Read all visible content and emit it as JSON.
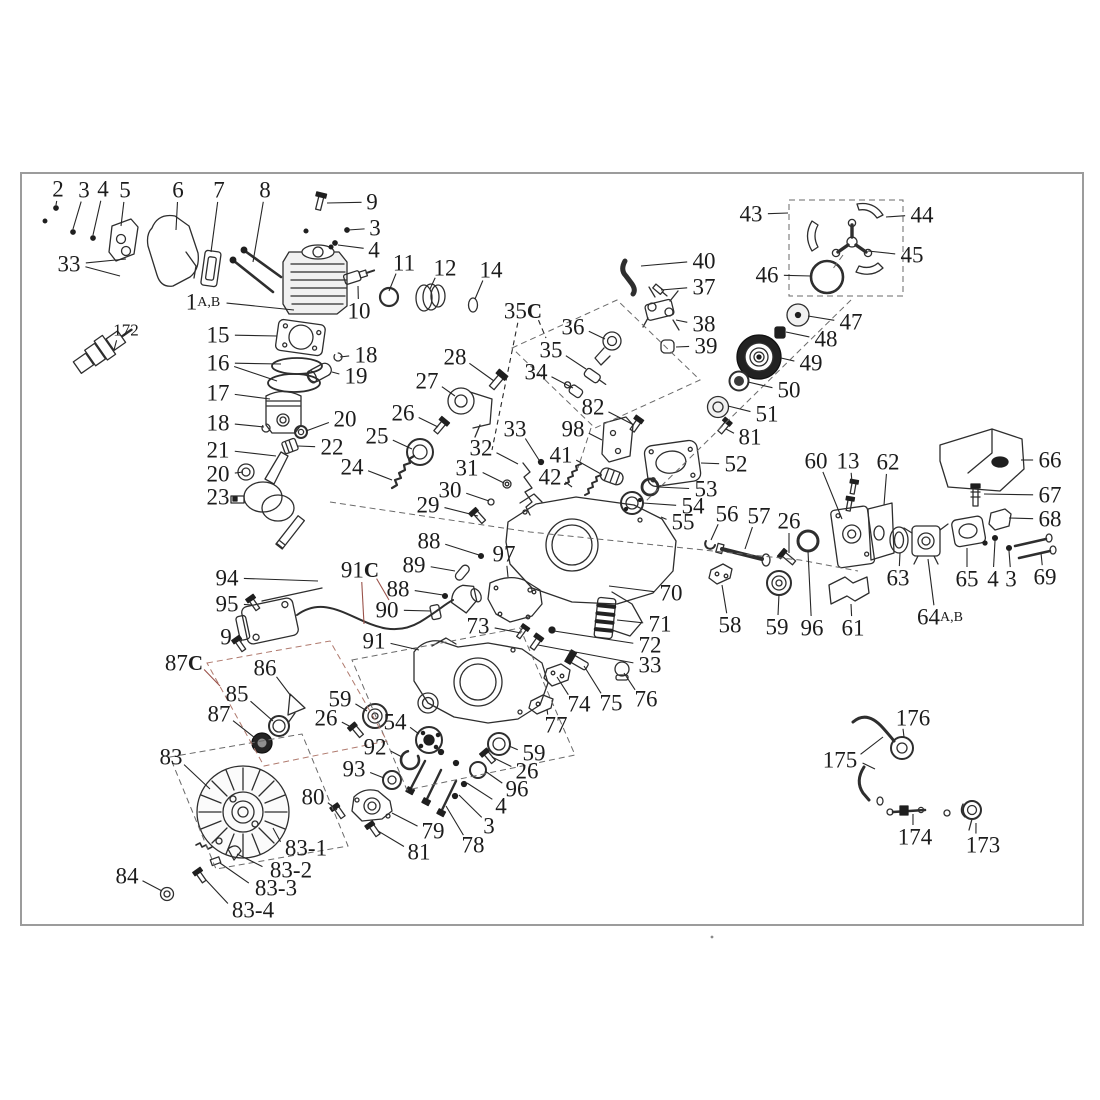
{
  "figure": {
    "title": "exploded-parts-diagram",
    "width": 1100,
    "height": 1100,
    "bg": "#ffffff",
    "ink": "#1c1c1c",
    "part_stroke": "#2e2e2e",
    "accent": "#9a524a",
    "frame": {
      "x": 21,
      "y": 173,
      "w": 1062,
      "h": 752,
      "color": "#9c9c9c"
    },
    "label_font_size": 23,
    "small_label_font_size": 17,
    "speck": {
      "x": 712,
      "y": 937
    }
  },
  "callouts": [
    {
      "t": "2",
      "x": 58,
      "y": 189,
      "l": [
        [
          56,
          205
        ]
      ]
    },
    {
      "t": "3",
      "x": 84,
      "y": 190,
      "l": [
        [
          73,
          229
        ]
      ]
    },
    {
      "t": "4",
      "x": 103,
      "y": 189,
      "l": [
        [
          93,
          235
        ]
      ]
    },
    {
      "t": "5",
      "x": 125,
      "y": 190,
      "l": [
        [
          121,
          226
        ]
      ]
    },
    {
      "t": "6",
      "x": 178,
      "y": 190,
      "l": [
        [
          176,
          230
        ]
      ]
    },
    {
      "t": "7",
      "x": 219,
      "y": 190,
      "l": [
        [
          211,
          252
        ]
      ]
    },
    {
      "t": "8",
      "x": 265,
      "y": 190,
      "l": [
        [
          253,
          262
        ]
      ]
    },
    {
      "t": "9",
      "x": 372,
      "y": 202,
      "l": [
        [
          327,
          203
        ]
      ]
    },
    {
      "t": "3",
      "x": 375,
      "y": 228,
      "l": [
        [
          348,
          230
        ]
      ]
    },
    {
      "t": "4",
      "x": 374,
      "y": 250,
      "l": [
        [
          338,
          245
        ]
      ]
    },
    {
      "t": "33",
      "x": 69,
      "y": 264,
      "l": [
        [
          126,
          259
        ],
        [
          120,
          276
        ]
      ]
    },
    {
      "t": "1",
      "sub": "A,B",
      "x": 203,
      "y": 302,
      "l": [
        [
          294,
          310
        ]
      ]
    },
    {
      "t": "10",
      "x": 359,
      "y": 311,
      "l": [
        [
          358,
          286
        ]
      ]
    },
    {
      "t": "172",
      "x": 126,
      "y": 330,
      "s": 17,
      "l": [
        [
          114,
          350
        ]
      ]
    },
    {
      "t": "11",
      "x": 404,
      "y": 263,
      "l": [
        [
          389,
          291
        ]
      ]
    },
    {
      "t": "12",
      "x": 445,
      "y": 268,
      "l": [
        [
          430,
          289
        ]
      ]
    },
    {
      "t": "14",
      "x": 491,
      "y": 270,
      "l": [
        [
          475,
          299
        ]
      ]
    },
    {
      "t": "15",
      "x": 218,
      "y": 335,
      "l": [
        [
          277,
          336
        ]
      ]
    },
    {
      "t": "16",
      "x": 218,
      "y": 363,
      "l": [
        [
          281,
          364
        ],
        [
          277,
          381
        ]
      ]
    },
    {
      "t": "17",
      "x": 218,
      "y": 393,
      "l": [
        [
          270,
          399
        ]
      ]
    },
    {
      "t": "18",
      "x": 366,
      "y": 355,
      "l": [
        [
          340,
          357
        ]
      ]
    },
    {
      "t": "19",
      "x": 356,
      "y": 376,
      "l": [
        [
          332,
          372
        ]
      ]
    },
    {
      "t": "18",
      "x": 218,
      "y": 423,
      "l": [
        [
          264,
          427
        ]
      ]
    },
    {
      "t": "20",
      "x": 345,
      "y": 419,
      "l": [
        [
          306,
          431
        ]
      ]
    },
    {
      "t": "21",
      "x": 218,
      "y": 450,
      "l": [
        [
          276,
          456
        ]
      ]
    },
    {
      "t": "22",
      "x": 332,
      "y": 447,
      "l": [
        [
          298,
          446
        ]
      ]
    },
    {
      "t": "20",
      "x": 218,
      "y": 474,
      "l": [
        [
          243,
          472
        ]
      ]
    },
    {
      "t": "23",
      "x": 218,
      "y": 497,
      "l": [
        [
          235,
          499
        ]
      ]
    },
    {
      "t": "24",
      "x": 352,
      "y": 467,
      "l": [
        [
          392,
          480
        ]
      ]
    },
    {
      "t": "25",
      "x": 377,
      "y": 436,
      "l": [
        [
          412,
          449
        ]
      ]
    },
    {
      "t": "26",
      "x": 403,
      "y": 413,
      "l": [
        [
          438,
          427
        ]
      ]
    },
    {
      "t": "27",
      "x": 427,
      "y": 381,
      "l": [
        [
          455,
          396
        ]
      ]
    },
    {
      "t": "28",
      "x": 455,
      "y": 357,
      "l": [
        [
          494,
          381
        ]
      ]
    },
    {
      "t": "29",
      "x": 428,
      "y": 505,
      "l": [
        [
          478,
          516
        ]
      ]
    },
    {
      "t": "30",
      "x": 450,
      "y": 490,
      "l": [
        [
          489,
          501
        ]
      ]
    },
    {
      "t": "31",
      "x": 467,
      "y": 468,
      "l": [
        [
          504,
          483
        ]
      ]
    },
    {
      "t": "32",
      "x": 481,
      "y": 448,
      "l": [
        [
          518,
          464
        ]
      ]
    },
    {
      "t": "33",
      "x": 515,
      "y": 429,
      "l": [
        [
          539,
          460
        ]
      ]
    },
    {
      "t": "35",
      "sufC": true,
      "dash": true,
      "x": 523,
      "y": 311,
      "l": [
        [
          492,
          450
        ],
        [
          546,
          338
        ]
      ]
    },
    {
      "t": "36",
      "x": 573,
      "y": 327,
      "l": [
        [
          605,
          339
        ]
      ]
    },
    {
      "t": "35",
      "x": 551,
      "y": 350,
      "l": [
        [
          586,
          369
        ]
      ]
    },
    {
      "t": "34",
      "x": 536,
      "y": 372,
      "l": [
        [
          573,
          388
        ]
      ]
    },
    {
      "t": "40",
      "x": 704,
      "y": 261,
      "l": [
        [
          641,
          266
        ]
      ]
    },
    {
      "t": "37",
      "x": 704,
      "y": 287,
      "l": [
        [
          661,
          290
        ]
      ]
    },
    {
      "t": "38",
      "x": 704,
      "y": 324,
      "l": [
        [
          676,
          320
        ]
      ]
    },
    {
      "t": "39",
      "x": 706,
      "y": 346,
      "l": [
        [
          676,
          347
        ]
      ]
    },
    {
      "t": "82",
      "x": 593,
      "y": 407,
      "l": [
        [
          634,
          425
        ]
      ]
    },
    {
      "t": "98",
      "x": 573,
      "y": 429,
      "l": [
        [
          602,
          440
        ]
      ]
    },
    {
      "t": "41",
      "x": 561,
      "y": 455,
      "l": [
        [
          601,
          474
        ]
      ]
    },
    {
      "t": "42",
      "x": 550,
      "y": 477,
      "l": [
        [
          572,
          487
        ]
      ]
    },
    {
      "t": "43",
      "x": 751,
      "y": 214,
      "l": [
        [
          788,
          213
        ]
      ]
    },
    {
      "t": "44",
      "x": 922,
      "y": 215,
      "l": [
        [
          886,
          217
        ]
      ]
    },
    {
      "t": "45",
      "x": 912,
      "y": 255,
      "l": [
        [
          868,
          251
        ]
      ]
    },
    {
      "t": "46",
      "x": 767,
      "y": 275,
      "l": [
        [
          811,
          276
        ]
      ]
    },
    {
      "t": "47",
      "x": 851,
      "y": 322,
      "l": [
        [
          808,
          316
        ]
      ]
    },
    {
      "t": "48",
      "x": 826,
      "y": 339,
      "l": [
        [
          786,
          332
        ]
      ]
    },
    {
      "t": "49",
      "x": 811,
      "y": 363,
      "l": [
        [
          781,
          358
        ]
      ]
    },
    {
      "t": "50",
      "x": 789,
      "y": 390,
      "l": [
        [
          748,
          382
        ]
      ]
    },
    {
      "t": "51",
      "x": 767,
      "y": 414,
      "l": [
        [
          728,
          406
        ]
      ]
    },
    {
      "t": "81",
      "x": 750,
      "y": 437,
      "l": [
        [
          726,
          429
        ]
      ]
    },
    {
      "t": "52",
      "x": 736,
      "y": 464,
      "l": [
        [
          701,
          463
        ]
      ]
    },
    {
      "t": "53",
      "x": 706,
      "y": 489,
      "l": [
        [
          658,
          487
        ]
      ]
    },
    {
      "t": "54",
      "x": 693,
      "y": 506,
      "l": [
        [
          643,
          503
        ]
      ]
    },
    {
      "t": "55",
      "x": 683,
      "y": 522,
      "l": [
        [
          661,
          517
        ]
      ]
    },
    {
      "t": "56",
      "x": 727,
      "y": 514,
      "l": [
        [
          711,
          540
        ]
      ]
    },
    {
      "t": "57",
      "x": 759,
      "y": 516,
      "l": [
        [
          745,
          549
        ]
      ]
    },
    {
      "t": "26",
      "x": 789,
      "y": 521,
      "l": [
        [
          789,
          553
        ]
      ]
    },
    {
      "t": "60",
      "x": 816,
      "y": 461,
      "l": [
        [
          842,
          519
        ]
      ]
    },
    {
      "t": "13",
      "x": 848,
      "y": 461,
      "l": [
        [
          852,
          482
        ]
      ]
    },
    {
      "t": "62",
      "x": 888,
      "y": 462,
      "l": [
        [
          884,
          505
        ]
      ]
    },
    {
      "t": "66",
      "x": 1050,
      "y": 460,
      "l": [
        [
          1021,
          460
        ]
      ]
    },
    {
      "t": "67",
      "x": 1050,
      "y": 495,
      "l": [
        [
          984,
          494
        ]
      ]
    },
    {
      "t": "68",
      "x": 1050,
      "y": 519,
      "l": [
        [
          1009,
          518
        ]
      ]
    },
    {
      "t": "69",
      "x": 1045,
      "y": 577,
      "l": [
        [
          1041,
          553
        ]
      ]
    },
    {
      "t": "3",
      "x": 1011,
      "y": 579,
      "l": [
        [
          1009,
          551
        ]
      ]
    },
    {
      "t": "4",
      "x": 993,
      "y": 579,
      "l": [
        [
          995,
          541
        ]
      ]
    },
    {
      "t": "65",
      "x": 967,
      "y": 579,
      "l": [
        [
          967,
          548
        ]
      ]
    },
    {
      "t": "64",
      "sub": "A,B",
      "x": 940,
      "y": 617,
      "l": [
        [
          928,
          559
        ]
      ]
    },
    {
      "t": "63",
      "x": 898,
      "y": 578,
      "l": [
        [
          900,
          553
        ]
      ]
    },
    {
      "t": "61",
      "x": 853,
      "y": 628,
      "l": [
        [
          851,
          604
        ]
      ]
    },
    {
      "t": "96",
      "x": 812,
      "y": 628,
      "l": [
        [
          808,
          551
        ]
      ]
    },
    {
      "t": "59",
      "x": 777,
      "y": 627,
      "l": [
        [
          779,
          594
        ]
      ]
    },
    {
      "t": "58",
      "x": 730,
      "y": 625,
      "l": [
        [
          722,
          585
        ]
      ]
    },
    {
      "t": "70",
      "x": 671,
      "y": 593,
      "l": [
        [
          609,
          586
        ]
      ]
    },
    {
      "t": "71",
      "x": 660,
      "y": 624,
      "l": [
        [
          617,
          620
        ]
      ]
    },
    {
      "t": "72",
      "x": 650,
      "y": 645,
      "l": [
        [
          554,
          631
        ]
      ]
    },
    {
      "t": "33",
      "x": 650,
      "y": 665,
      "l": [
        [
          538,
          645
        ]
      ]
    },
    {
      "t": "73",
      "x": 478,
      "y": 626,
      "l": [
        [
          521,
          633
        ]
      ]
    },
    {
      "t": "74",
      "x": 579,
      "y": 704,
      "l": [
        [
          557,
          677
        ]
      ]
    },
    {
      "t": "75",
      "x": 611,
      "y": 703,
      "l": [
        [
          584,
          666
        ]
      ]
    },
    {
      "t": "76",
      "x": 646,
      "y": 699,
      "l": [
        [
          624,
          673
        ]
      ]
    },
    {
      "t": "77",
      "x": 556,
      "y": 725,
      "l": [
        [
          547,
          709
        ]
      ]
    },
    {
      "t": "88",
      "x": 429,
      "y": 541,
      "l": [
        [
          479,
          555
        ]
      ]
    },
    {
      "t": "97",
      "x": 504,
      "y": 554,
      "l": [
        [
          508,
          577
        ]
      ]
    },
    {
      "t": "89",
      "x": 414,
      "y": 565,
      "l": [
        [
          455,
          571
        ]
      ]
    },
    {
      "t": "88",
      "x": 398,
      "y": 589,
      "l": [
        [
          443,
          595
        ]
      ]
    },
    {
      "t": "90",
      "x": 387,
      "y": 610,
      "l": [
        [
          431,
          611
        ]
      ]
    },
    {
      "t": "91",
      "x": 374,
      "y": 641,
      "l": [
        [
          419,
          650
        ]
      ]
    },
    {
      "t": "91",
      "sufC": true,
      "accent": true,
      "x": 360,
      "y": 570,
      "l": [
        [
          364,
          624
        ],
        [
          389,
          600
        ]
      ]
    },
    {
      "t": "94",
      "x": 227,
      "y": 578,
      "l": [
        [
          318,
          581
        ]
      ]
    },
    {
      "t": "95",
      "x": 227,
      "y": 604,
      "l": [
        [
          252,
          605
        ]
      ]
    },
    {
      "t": "9",
      "x": 226,
      "y": 637,
      "l": [
        [
          242,
          641
        ]
      ]
    },
    {
      "t": "87",
      "sufC": true,
      "accent": true,
      "x": 184,
      "y": 663,
      "l": [
        [
          220,
          686
        ]
      ]
    },
    {
      "t": "86",
      "x": 265,
      "y": 668,
      "l": [
        [
          291,
          696
        ]
      ]
    },
    {
      "t": "85",
      "x": 237,
      "y": 694,
      "l": [
        [
          273,
          721
        ]
      ]
    },
    {
      "t": "87",
      "x": 219,
      "y": 714,
      "l": [
        [
          255,
          738
        ]
      ]
    },
    {
      "t": "59",
      "x": 340,
      "y": 699,
      "l": [
        [
          367,
          711
        ]
      ]
    },
    {
      "t": "26",
      "x": 326,
      "y": 718,
      "l": [
        [
          353,
          728
        ]
      ]
    },
    {
      "t": "54",
      "x": 395,
      "y": 722,
      "l": [
        [
          419,
          734
        ]
      ]
    },
    {
      "t": "92",
      "x": 375,
      "y": 747,
      "l": [
        [
          402,
          757
        ]
      ]
    },
    {
      "t": "93",
      "x": 354,
      "y": 769,
      "l": [
        [
          384,
          778
        ]
      ]
    },
    {
      "t": "83",
      "x": 171,
      "y": 757,
      "l": [
        [
          210,
          789
        ]
      ]
    },
    {
      "t": "80",
      "x": 313,
      "y": 797,
      "l": [
        [
          337,
          810
        ]
      ]
    },
    {
      "t": "79",
      "x": 433,
      "y": 831,
      "l": [
        [
          392,
          813
        ]
      ]
    },
    {
      "t": "81",
      "x": 419,
      "y": 852,
      "l": [
        [
          378,
          831
        ]
      ]
    },
    {
      "t": "78",
      "x": 473,
      "y": 845,
      "l": [
        [
          446,
          806
        ]
      ]
    },
    {
      "t": "3",
      "x": 489,
      "y": 826,
      "l": [
        [
          459,
          795
        ]
      ]
    },
    {
      "t": "4",
      "x": 501,
      "y": 806,
      "l": [
        [
          467,
          783
        ]
      ]
    },
    {
      "t": "96",
      "x": 517,
      "y": 789,
      "l": [
        [
          485,
          771
        ]
      ]
    },
    {
      "t": "26",
      "x": 527,
      "y": 771,
      "l": [
        [
          492,
          757
        ]
      ]
    },
    {
      "t": "59",
      "x": 534,
      "y": 753,
      "l": [
        [
          509,
          746
        ]
      ]
    },
    {
      "t": "83-1",
      "x": 306,
      "y": 848,
      "l": [
        [
          273,
          828
        ]
      ]
    },
    {
      "t": "83-2",
      "x": 291,
      "y": 870,
      "l": [
        [
          237,
          854
        ]
      ]
    },
    {
      "t": "83-3",
      "x": 276,
      "y": 888,
      "l": [
        [
          220,
          863
        ]
      ]
    },
    {
      "t": "83-4",
      "x": 253,
      "y": 910,
      "l": [
        [
          206,
          880
        ]
      ]
    },
    {
      "t": "84",
      "x": 127,
      "y": 876,
      "l": [
        [
          162,
          891
        ]
      ]
    },
    {
      "t": "175",
      "x": 840,
      "y": 760,
      "l": [
        [
          883,
          737
        ],
        [
          875,
          769
        ]
      ]
    },
    {
      "t": "176",
      "x": 913,
      "y": 718,
      "l": [
        [
          904,
          737
        ]
      ]
    },
    {
      "t": "174",
      "x": 915,
      "y": 837,
      "l": [
        [
          913,
          814
        ]
      ]
    },
    {
      "t": "173",
      "x": 983,
      "y": 845,
      "l": [
        [
          976,
          823
        ]
      ]
    }
  ]
}
